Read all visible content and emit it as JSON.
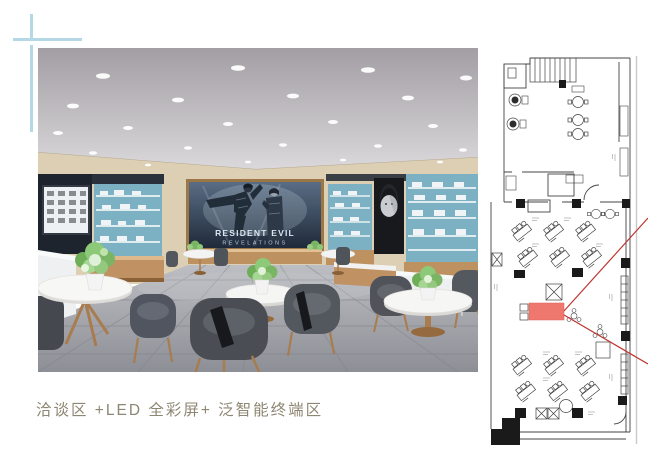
{
  "page": {
    "caption": "洽谈区 +LED 全彩屏+ 泛智能终端区"
  },
  "rendering": {
    "description_labels": {
      "led_screen_title_line1": "RESIDENT EVIL",
      "led_screen_title_line2": "REVELATIONS"
    }
  },
  "colors": {
    "cross_accent": "#b5d8e7",
    "caption_text": "#8d8672",
    "wall_beige": "#dccfb3",
    "shelf_teal": "#7cb0c3",
    "wood": "#c09162",
    "plan_line": "#444444",
    "plan_highlight_fill": "#ee6a5f",
    "plan_sightline": "#bf3530"
  }
}
